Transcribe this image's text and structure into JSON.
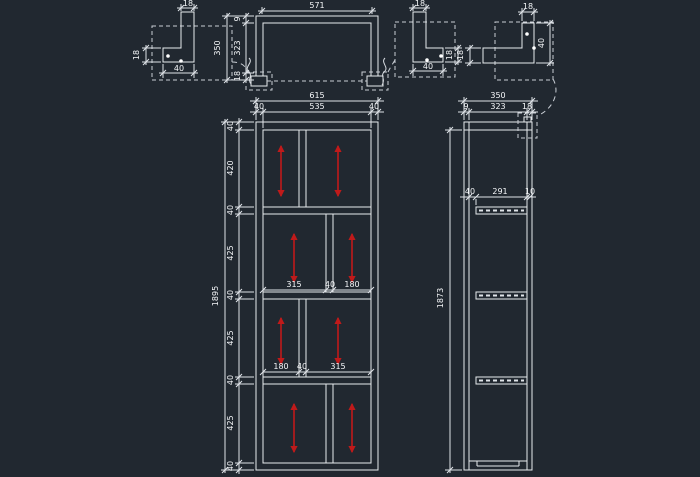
{
  "canvas": {
    "background_color": "#212830",
    "line_color": "#e8ebee",
    "dim_text_color": "#f4f6f8",
    "arrow_color": "#c01a1a"
  },
  "plan_view": {
    "dim_width_inner": "571",
    "dim_depth_total": "350",
    "depth_chain": [
      "9",
      "323",
      "18"
    ]
  },
  "front_view": {
    "dim_width_total": "615",
    "width_chain": [
      "40",
      "535",
      "40"
    ],
    "dim_height_total": "1895",
    "height_chain": [
      "40",
      "420",
      "40",
      "425",
      "40",
      "425",
      "40",
      "425",
      "40"
    ],
    "row2_chain": [
      "315",
      "40",
      "180"
    ],
    "row3_chain": [
      "180",
      "40",
      "315"
    ]
  },
  "side_view": {
    "dim_depth_total": "350",
    "depth_chain": [
      "9",
      "323",
      "18"
    ],
    "dim_height_inner": "1873",
    "shelf_chain": [
      "40",
      "291",
      "10"
    ]
  },
  "detail_left": {
    "dim_stem_width": "18",
    "dim_bar_height": "18",
    "dim_bar_length": "40"
  },
  "detail_middle": {
    "dim_stem_width": "18",
    "dim_bar_height": "18",
    "dim_bar_length": "40"
  },
  "detail_right": {
    "dim_stem_width": "18",
    "dim_stem_height": "40",
    "dim_bar_height": "18"
  }
}
